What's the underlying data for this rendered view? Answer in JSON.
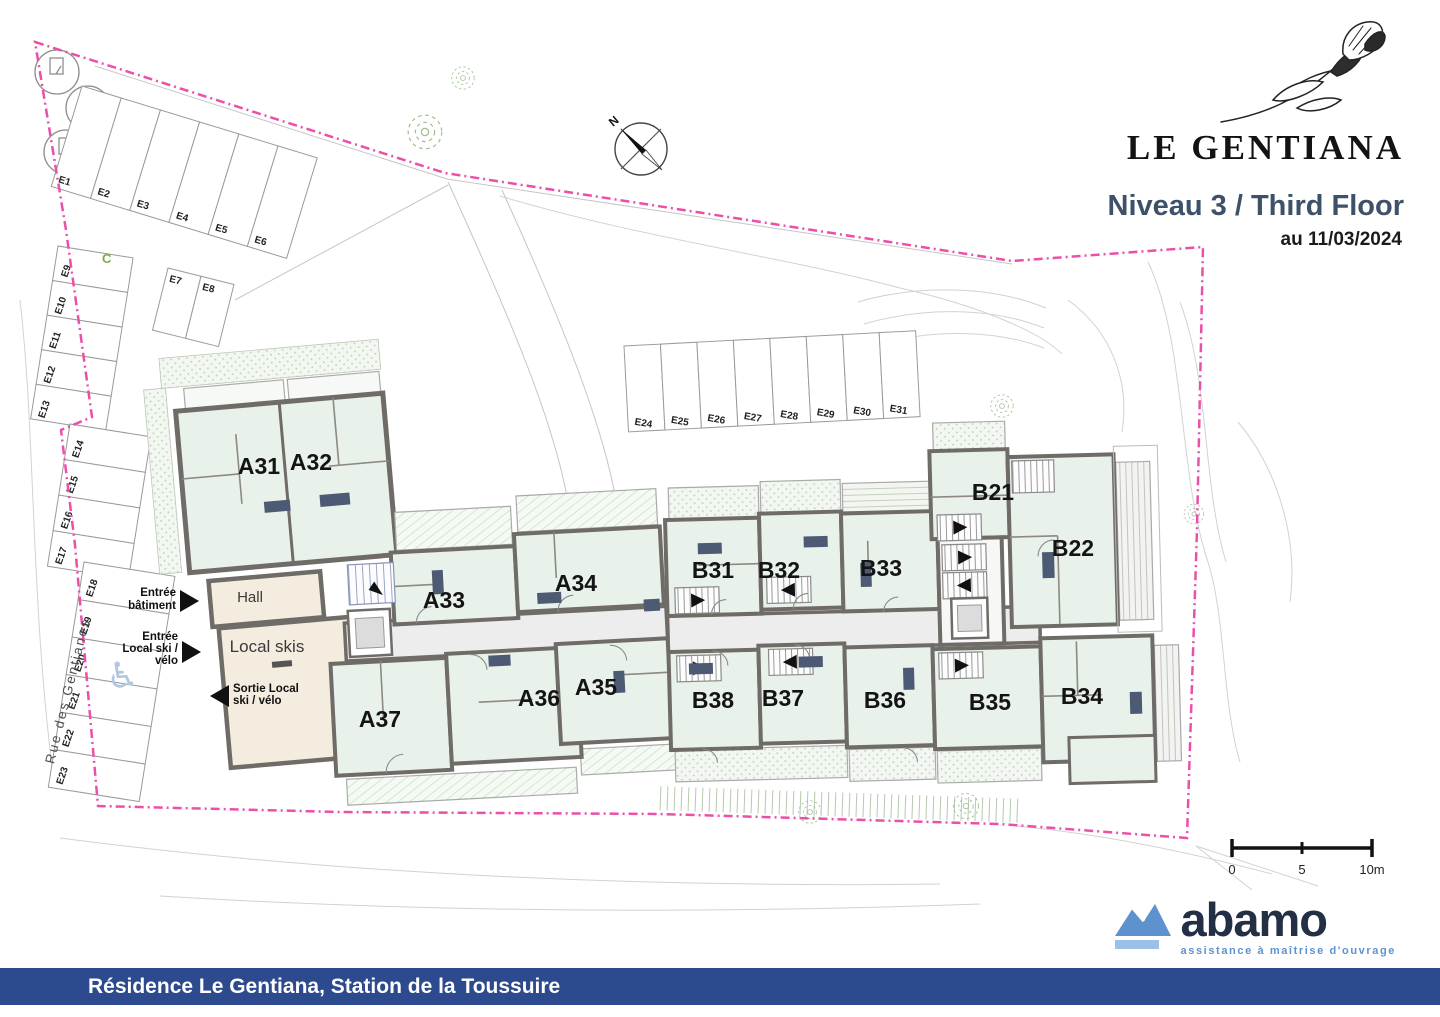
{
  "title_block": {
    "project": "LE GENTIANA",
    "level": "Niveau 3 / Third Floor",
    "date": "au 11/03/2024"
  },
  "icons": {
    "flower": "gentian-flower-sketch",
    "compass": "compass-rose-north",
    "wheelchair": "accessible-parking-symbol",
    "logo_mark": "abamo-mountain-mark"
  },
  "compass": {
    "north_label": "N"
  },
  "site": {
    "street_name": "Rue des Gentianes",
    "zone_label": "C"
  },
  "rooms": {
    "hall": "Hall",
    "local_skis": "Local skis"
  },
  "entries": {
    "building": {
      "line1": "Entrée",
      "line2": "bâtiment"
    },
    "ski_local_in": {
      "line1": "Entrée",
      "line2": "Local ski /",
      "line3": "vélo"
    },
    "ski_local_out": {
      "line1": "Sortie Local",
      "line2": "ski / vélo"
    }
  },
  "units": {
    "A31": "A31",
    "A32": "A32",
    "A33": "A33",
    "A34": "A34",
    "A35": "A35",
    "A36": "A36",
    "A37": "A37",
    "B21": "B21",
    "B22": "B22",
    "B31": "B31",
    "B32": "B32",
    "B33": "B33",
    "B34": "B34",
    "B35": "B35",
    "B36": "B36",
    "B37": "B37",
    "B38": "B38"
  },
  "parking": {
    "spaces": [
      "E1",
      "E2",
      "E3",
      "E4",
      "E5",
      "E6",
      "E7",
      "E8",
      "E9",
      "E10",
      "E11",
      "E12",
      "E13",
      "E14",
      "E15",
      "E16",
      "E17",
      "E18",
      "E19",
      "E20",
      "E21",
      "E22",
      "E23",
      "E24",
      "E25",
      "E26",
      "E27",
      "E28",
      "E29",
      "E30",
      "E31"
    ]
  },
  "scale_bar": {
    "zero": "0",
    "mid": "5",
    "end": "10m"
  },
  "logo": {
    "name": "abamo",
    "tagline": "assistance à maîtrise d'ouvrage"
  },
  "footer": {
    "text": "Résidence Le Gentiana, Station de la Toussuire"
  },
  "colors": {
    "boundary_pink": "#ec4fa8",
    "heading_blue": "#3d5169",
    "footer_blue": "#2d4a8e",
    "logo_navy": "#232f44",
    "logo_blue": "#5e92ce",
    "unit_fill": "#e9f2ea",
    "service_fill": "#f3ecdf",
    "wall_grey": "#6f6b67",
    "zone_green": "#76b043"
  }
}
